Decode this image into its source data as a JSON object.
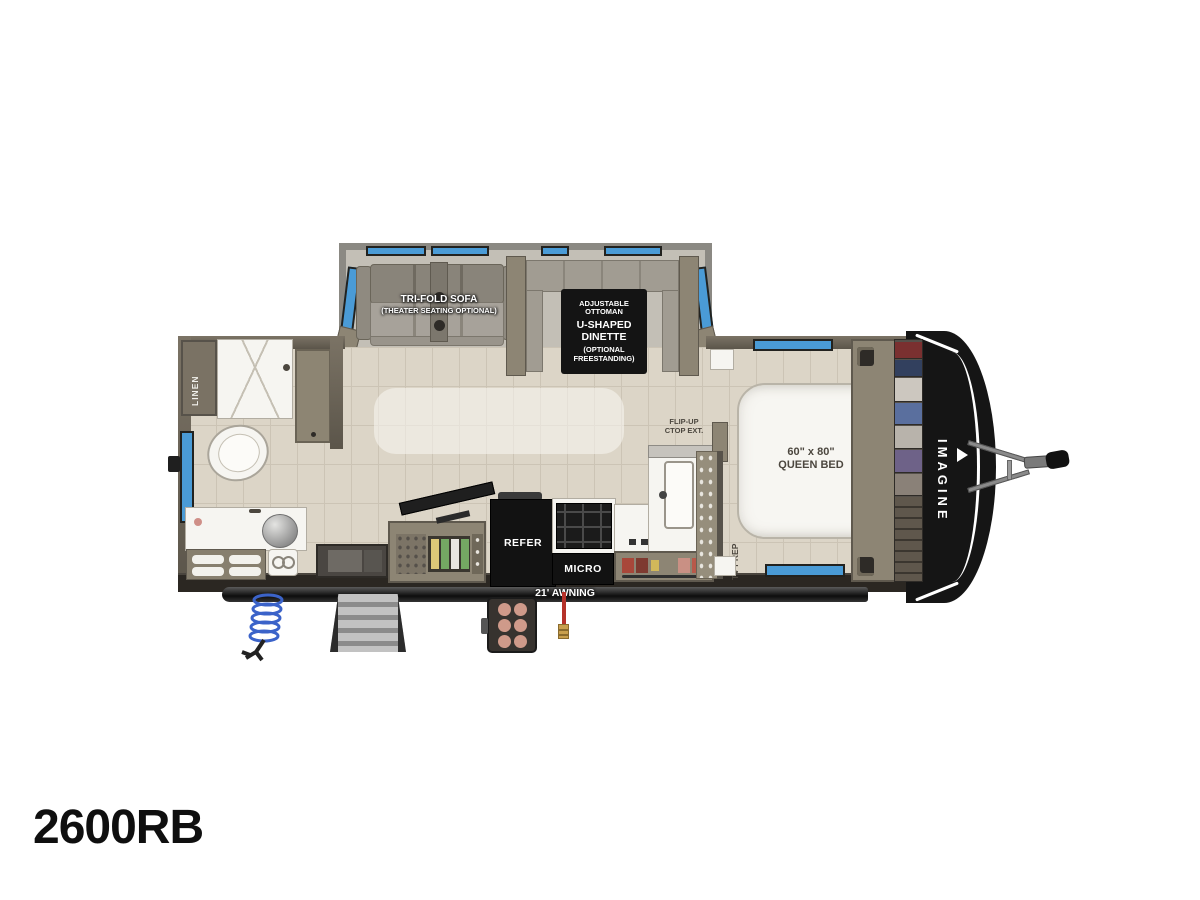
{
  "model_label": "2600RB",
  "floorplan": {
    "brand": "IMAGINE",
    "awning": {
      "label": "21' AWNING"
    },
    "slideout": {
      "sofa": {
        "line1": "TRI-FOLD SOFA",
        "line2": "(THEATER SEATING OPTIONAL)"
      },
      "dinette": {
        "line1": "ADJUSTABLE",
        "line2": "OTTOMAN",
        "line3": "U-SHAPED",
        "line4": "DINETTE",
        "line5": "(OPTIONAL",
        "line6": "FREESTANDING)"
      }
    },
    "bathroom": {
      "linen": "LINEN"
    },
    "kitchen": {
      "refrigerator": "REFER",
      "microwave": "MICRO",
      "flip_up_line1": "FLIP-UP",
      "flip_up_line2": "CTOP EXT.",
      "tv_prep": "TV PREP"
    },
    "bedroom": {
      "bed_size": "60\" x 80\"",
      "bed_type": "QUEEN BED"
    }
  },
  "colors": {
    "window_blue": "#4a9bd6",
    "wall_olive": "#6b6456",
    "slide_wall_gray": "#8b8983",
    "floor_tile": "#dcd5c7",
    "front_cap_black": "#151515",
    "awning_bar": "#1f1f1f",
    "coil_blue": "#3b63c9",
    "strap_red": "#b5322a"
  }
}
